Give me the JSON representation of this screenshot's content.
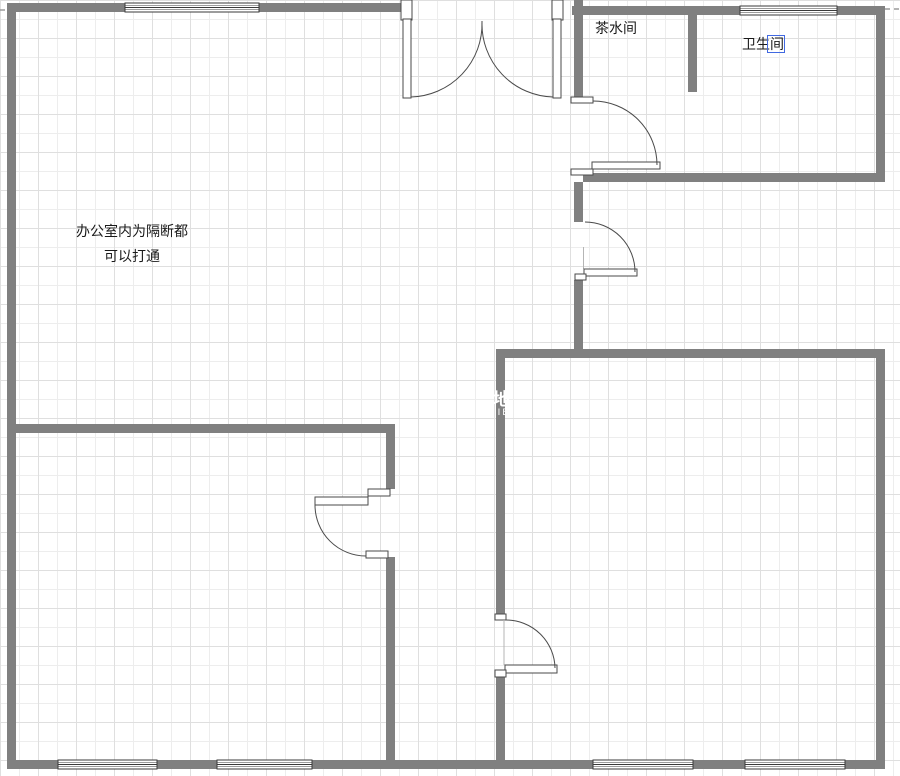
{
  "labels": {
    "tea_room": "茶水间",
    "bathroom": "卫生间",
    "office_note_line1": "办公室内为隔断都",
    "office_note_line2": "可以打通"
  },
  "watermark": {
    "line1": "地",
    "line2": "IE"
  },
  "colors": {
    "background": "#ffffff",
    "wall": "#808080",
    "door_stroke": "#4a4a4a",
    "window_stroke": "#3a3a3a",
    "grid_minor": "#ededed",
    "grid_major": "#dfdfdf",
    "text": "#1a1a1a",
    "selection": "#4169e1"
  }
}
